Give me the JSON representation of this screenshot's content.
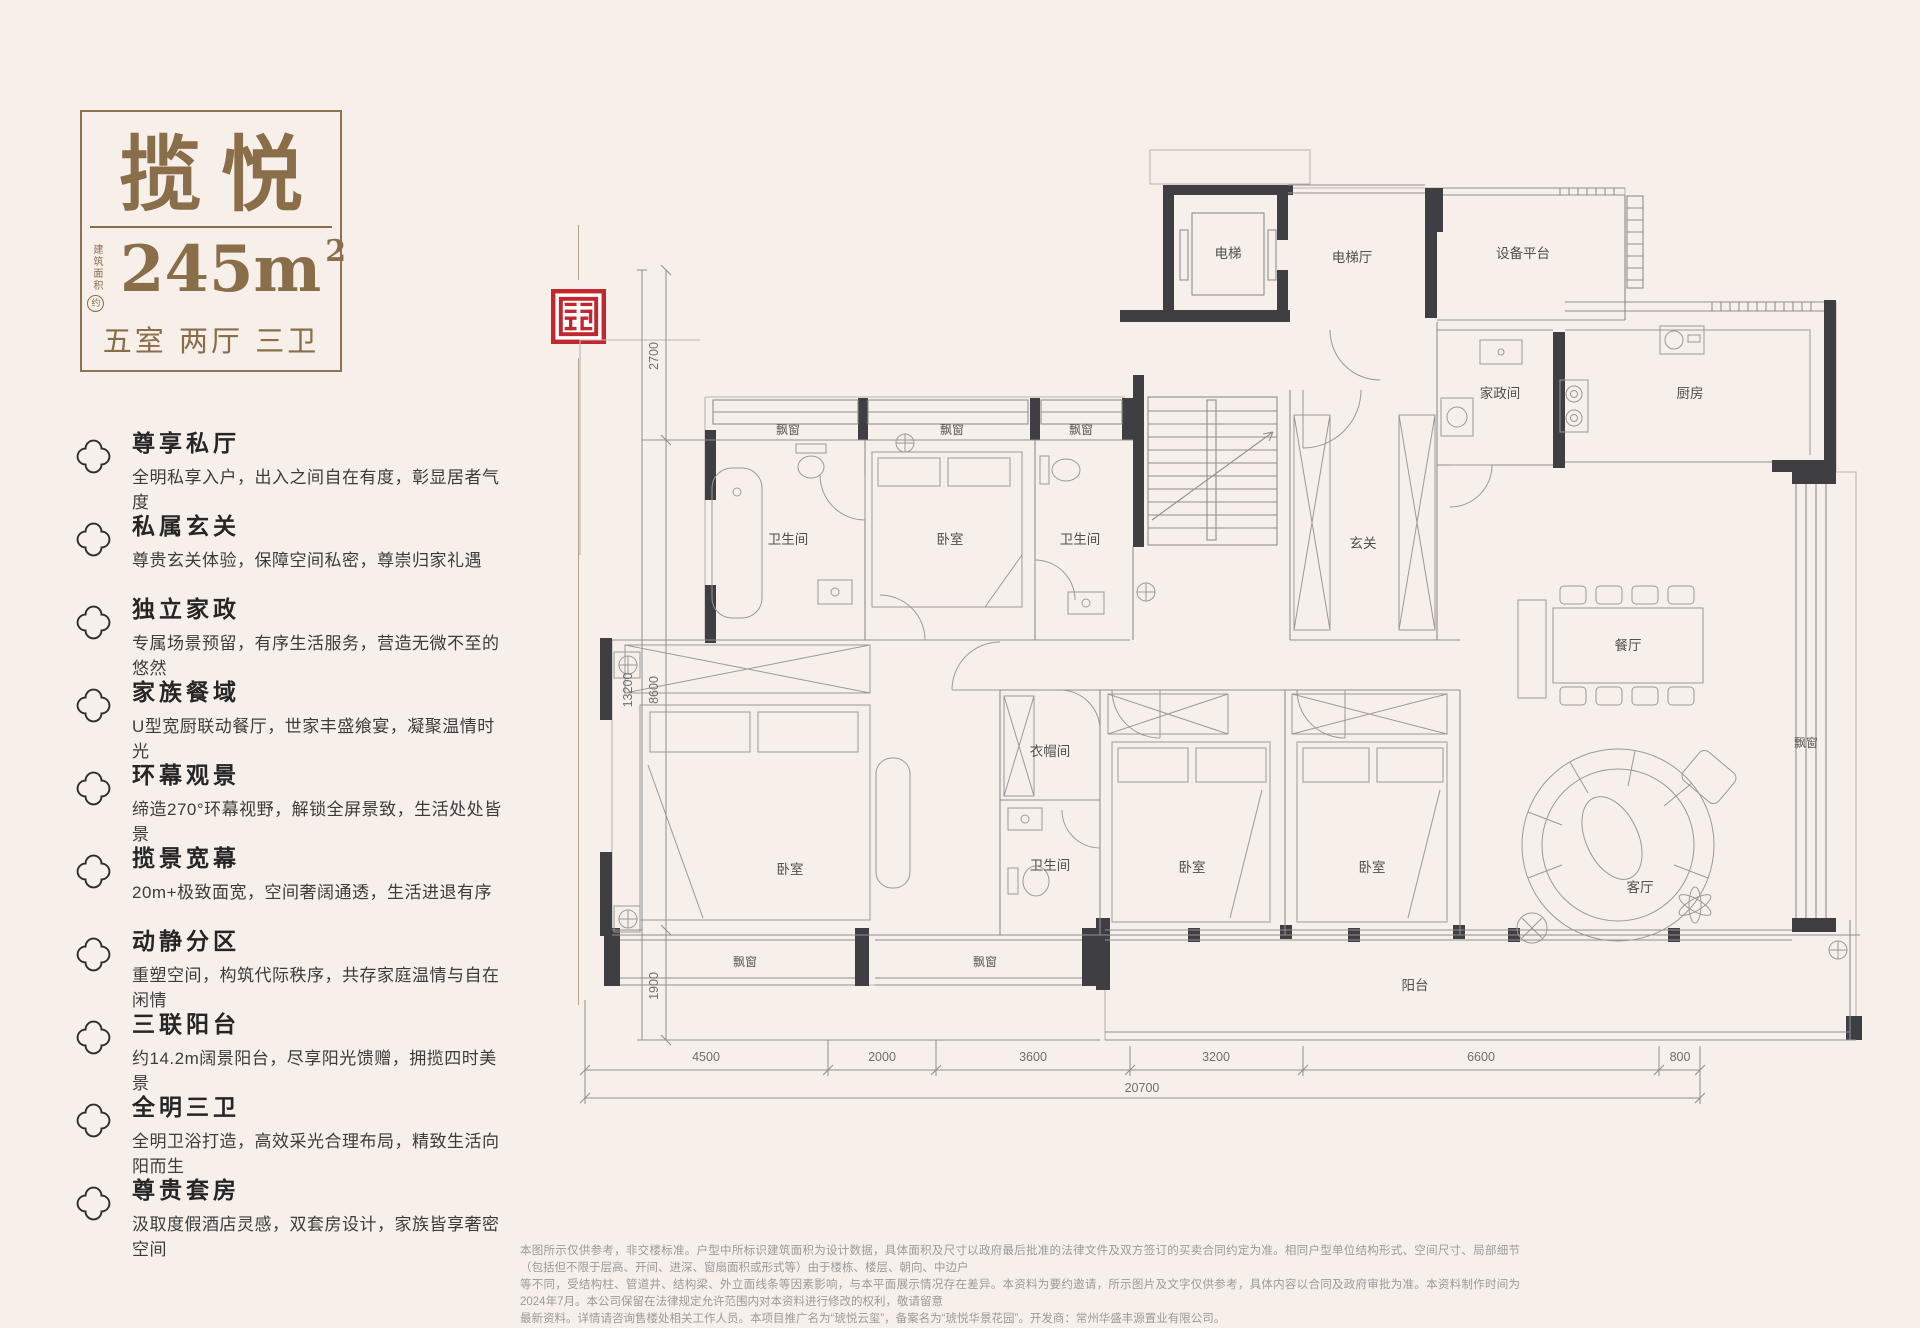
{
  "title_card": {
    "name": "揽悦",
    "area_label_vertical": "建筑面积",
    "area_approx": "约",
    "area_value": "245m",
    "area_sup": "2",
    "layout": "五室 两厅 三卫",
    "accent_color": "#8a6e49"
  },
  "seal_color": "#c1272d",
  "features": [
    {
      "title": "尊享私厅",
      "desc": "全明私享入户，出入之间自在有度，彰显居者气度"
    },
    {
      "title": "私属玄关",
      "desc": "尊贵玄关体验，保障空间私密，尊崇归家礼遇"
    },
    {
      "title": "独立家政",
      "desc": "专属场景预留，有序生活服务，营造无微不至的悠然"
    },
    {
      "title": "家族餐域",
      "desc": "U型宽厨联动餐厅，世家丰盛飨宴，凝聚温情时光"
    },
    {
      "title": "环幕观景",
      "desc": "缔造270°环幕视野，解锁全屏景致，生活处处皆景"
    },
    {
      "title": "揽景宽幕",
      "desc": "20m+极致面宽，空间奢阔通透，生活进退有序"
    },
    {
      "title": "动静分区",
      "desc": "重塑空间，构筑代际秩序，共存家庭温情与自在闲情"
    },
    {
      "title": "三联阳台",
      "desc": "约14.2m阔景阳台，尽享阳光馈赠，拥揽四时美景"
    },
    {
      "title": "全明三卫",
      "desc": "全明卫浴打造，高效采光合理布局，精致生活向阳而生"
    },
    {
      "title": "尊贵套房",
      "desc": "汲取度假酒店灵感，双套房设计，家族皆享奢密空间"
    }
  ],
  "floorplan": {
    "labels": {
      "elevator": "电梯",
      "elevator_hall": "电梯厅",
      "equipment_platform": "设备平台",
      "housekeeping": "家政间",
      "kitchen": "厨房",
      "foyer": "玄关",
      "dining": "餐厅",
      "living": "客厅",
      "balcony": "阳台",
      "cloakroom": "衣帽间",
      "bedroom": "卧室",
      "bathroom": "卫生间",
      "bay_window": "飘窗"
    },
    "dims_left": {
      "total": "13200",
      "segments": [
        "2700",
        "8600",
        "1900"
      ]
    },
    "dims_bottom": {
      "segments": [
        "4500",
        "2000",
        "3600",
        "3200",
        "6600",
        "800"
      ],
      "total": "20700"
    }
  },
  "disclaimer": {
    "lines": [
      "本图所示仅供参考，非交楼标准。户型中所标识建筑面积为设计数据，具体面积及尺寸以政府最后批准的法律文件及双方签订的买卖合同约定为准。相同户型单位结构形式、空间尺寸、局部细节（包括但不限于层高、开间、进深、窗扇面积或形式等）由于楼栋、楼层、朝向、中边户",
      "等不同，受结构柱、管道井、结构梁、外立面线条等因素影响，与本平面展示情况存在差异。本资料为要约邀请，所示图片及文字仅供参考，具体内容以合同及政府审批为准。本资料制作时间为2024年7月。本公司保留在法律规定允许范围内对本资料进行修改的权利，敬请留意",
      "最新资料。详情请咨询售楼处相关工作人员。本项目推广名为“琥悦云玺”，备案名为“琥悦华景花园”。开发商：常州华盛丰源置业有限公司。"
    ]
  }
}
